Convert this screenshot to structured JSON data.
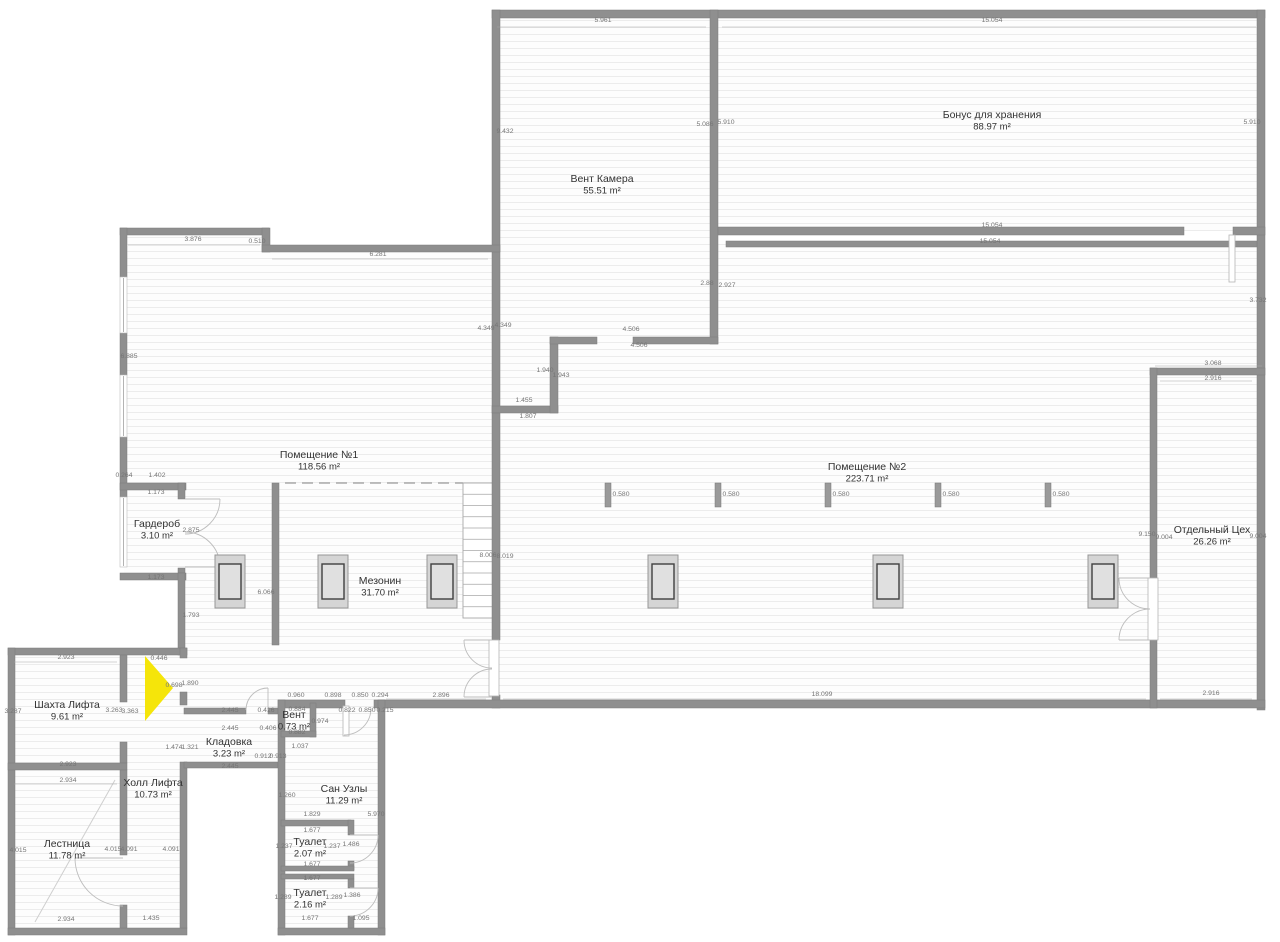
{
  "plan": {
    "colors": {
      "wall": "#8f8f8f",
      "floor_base": "#fdfdfd",
      "hatch_line": "#ececec",
      "highlight_arrow": "#f5e50a",
      "footing_fill": "#d5d5d5",
      "footing_stroke": "#969696",
      "footing_inner_fill": "#e0e0e0",
      "footing_inner_stroke": "#3f3f3f",
      "pillar_fill": "#9a9a9a",
      "dim_text": "#757575",
      "room_text": "#333333"
    },
    "rooms": [
      {
        "id": "vent-kamera",
        "label": "Вент Камера",
        "area": "55.51 m²",
        "x": 602,
        "y": 182
      },
      {
        "id": "bonus-dlya-hraneniya",
        "label": "Бонус для хранения",
        "area": "88.97 m²",
        "x": 992,
        "y": 118
      },
      {
        "id": "pomeshchenie-1",
        "label": "Помещение №1",
        "area": "118.56 m²",
        "x": 319,
        "y": 458
      },
      {
        "id": "pomeshchenie-2",
        "label": "Помещение №2",
        "area": "223.71 m²",
        "x": 867,
        "y": 470
      },
      {
        "id": "otdelny-ceh",
        "label": "Отдельный Цех",
        "area": "26.26 m²",
        "x": 1212,
        "y": 533
      },
      {
        "id": "mezonin",
        "label": "Мезонин",
        "area": "31.70 m²",
        "x": 380,
        "y": 584
      },
      {
        "id": "garderob",
        "label": "Гардероб",
        "area": "3.10 m²",
        "x": 157,
        "y": 527
      },
      {
        "id": "shahta-lifta",
        "label": "Шахта Лифта",
        "area": "9.61 m²",
        "x": 67,
        "y": 708
      },
      {
        "id": "holl-lifta",
        "label": "Холл Лифта",
        "area": "10.73 m²",
        "x": 153,
        "y": 786
      },
      {
        "id": "lestnica",
        "label": "Лестница",
        "area": "11.78 m²",
        "x": 67,
        "y": 847
      },
      {
        "id": "kladovka",
        "label": "Кладовка",
        "area": "3.23 m²",
        "x": 229,
        "y": 745
      },
      {
        "id": "vent",
        "label": "Вент",
        "area": "0.73 m²",
        "x": 294,
        "y": 718
      },
      {
        "id": "san-uzly",
        "label": "Сан Узлы",
        "area": "11.29 m²",
        "x": 344,
        "y": 792
      },
      {
        "id": "tualet-1",
        "label": "Туалет",
        "area": "2.07 m²",
        "x": 310,
        "y": 845
      },
      {
        "id": "tualet-2",
        "label": "Туалет",
        "area": "2.16 m²",
        "x": 310,
        "y": 896
      }
    ],
    "dims": [
      [
        "5.961",
        603,
        22
      ],
      [
        "15.054",
        992,
        22
      ],
      [
        "9.432",
        505,
        133
      ],
      [
        "5.086",
        705,
        126
      ],
      [
        "5.910",
        726,
        124
      ],
      [
        "5.910",
        1252,
        124
      ],
      [
        "15.054",
        992,
        227
      ],
      [
        "15.054",
        990,
        243
      ],
      [
        "3.876",
        193,
        241
      ],
      [
        "0.510",
        257,
        243
      ],
      [
        "6.281",
        378,
        256
      ],
      [
        "6.885",
        129,
        358
      ],
      [
        "2.88",
        707,
        285
      ],
      [
        "2.927",
        727,
        287
      ],
      [
        "4.349",
        486,
        330
      ],
      [
        "4.349",
        503,
        327
      ],
      [
        "4.506",
        631,
        331
      ],
      [
        "4.506",
        639,
        347
      ],
      [
        "3.732",
        1258,
        302
      ],
      [
        "1.940",
        545,
        372
      ],
      [
        "1.943",
        561,
        377
      ],
      [
        "1.455",
        524,
        402
      ],
      [
        "1.807",
        528,
        418
      ],
      [
        "3.068",
        1213,
        365
      ],
      [
        "2.916",
        1213,
        380
      ],
      [
        "0.264",
        124,
        477
      ],
      [
        "1.402",
        157,
        477
      ],
      [
        "1.173",
        156,
        494
      ],
      [
        "2.875",
        191,
        532
      ],
      [
        "1.173",
        156,
        579
      ],
      [
        "1.793",
        191,
        617
      ],
      [
        "6.066",
        266,
        594
      ],
      [
        "8.006",
        488,
        557
      ],
      [
        "8.019",
        505,
        558
      ],
      [
        "9.150",
        1147,
        536
      ],
      [
        "9.004",
        1164,
        539
      ],
      [
        "9.004",
        1258,
        538
      ],
      [
        "18.099",
        822,
        696
      ],
      [
        "2.916",
        1211,
        695
      ],
      [
        "2.896",
        441,
        697
      ],
      [
        "0.446",
        159,
        660
      ],
      [
        "2.923",
        66,
        659
      ],
      [
        "3.287",
        13,
        713
      ],
      [
        "3.263",
        114,
        712
      ],
      [
        "3.363",
        130,
        713
      ],
      [
        "0.698",
        174,
        687
      ],
      [
        "1.890",
        190,
        685
      ],
      [
        "1.474",
        174,
        749
      ],
      [
        "1.321",
        190,
        749
      ],
      [
        "2.923",
        68,
        766
      ],
      [
        "2.934",
        68,
        782
      ],
      [
        "2.445",
        230,
        712
      ],
      [
        "0.416",
        266,
        712
      ],
      [
        "2.445",
        230,
        730
      ],
      [
        "0.406",
        268,
        730
      ],
      [
        "0.912",
        263,
        758
      ],
      [
        "0.913",
        278,
        758
      ],
      [
        "2.445",
        230,
        768
      ],
      [
        "0.960",
        296,
        697
      ],
      [
        "0.898",
        333,
        697
      ],
      [
        "0.850",
        360,
        697
      ],
      [
        "0.294",
        380,
        697
      ],
      [
        "0.884",
        297,
        711
      ],
      [
        "0.822",
        347,
        712
      ],
      [
        "0.850",
        367,
        712
      ],
      [
        "0.215",
        385,
        712
      ],
      [
        "0.974",
        320,
        723
      ],
      [
        "0.882",
        297,
        734
      ],
      [
        "1.037",
        300,
        748
      ],
      [
        "1.260",
        287,
        797
      ],
      [
        "1.829",
        312,
        816
      ],
      [
        "5.970",
        376,
        816
      ],
      [
        "1.677",
        312,
        832
      ],
      [
        "1.237",
        284,
        848
      ],
      [
        "1.237",
        332,
        848
      ],
      [
        "1.486",
        351,
        846
      ],
      [
        "1.677",
        312,
        866
      ],
      [
        "1.677",
        312,
        880
      ],
      [
        "1.289",
        283,
        899
      ],
      [
        "1.289",
        334,
        899
      ],
      [
        "1.386",
        352,
        897
      ],
      [
        "1.677",
        310,
        920
      ],
      [
        "1.095",
        361,
        920
      ],
      [
        "4.015",
        18,
        852
      ],
      [
        "4.015",
        113,
        851
      ],
      [
        "4.091",
        129,
        851
      ],
      [
        "4.091",
        171,
        851
      ],
      [
        "2.934",
        66,
        921
      ],
      [
        "1.435",
        151,
        920
      ]
    ],
    "dim_lines": [
      [
        497,
        27,
        706,
        27
      ],
      [
        722,
        27,
        1256,
        27
      ],
      [
        128,
        245,
        260,
        245
      ],
      [
        272,
        259,
        488,
        259
      ],
      [
        503,
        699,
        1146,
        699
      ],
      [
        1160,
        699,
        1252,
        699
      ],
      [
        386,
        699,
        486,
        699
      ],
      [
        14,
        662,
        117,
        662
      ],
      [
        14,
        784,
        117,
        784
      ],
      [
        1155,
        366,
        1262,
        366
      ],
      [
        1160,
        381,
        1252,
        381
      ]
    ],
    "geometry": {
      "floors": [
        [
          124,
          232,
          144,
          346
        ],
        [
          268,
          249,
          228,
          455
        ],
        [
          185,
          578,
          83,
          126
        ],
        [
          497,
          14,
          216,
          397
        ],
        [
          715,
          14,
          546,
          217
        ],
        [
          715,
          244,
          546,
          460
        ],
        [
          553,
          341,
          165,
          363
        ],
        [
          496,
          411,
          60,
          293
        ],
        [
          12,
          652,
          172,
          280
        ],
        [
          282,
          704,
          100,
          228
        ],
        [
          184,
          652,
          98,
          114
        ]
      ],
      "walls": [
        [
          492,
          10,
          773,
          8
        ],
        [
          492,
          10,
          8,
          403
        ],
        [
          710,
          10,
          8,
          334
        ],
        [
          1257,
          10,
          8,
          700
        ],
        [
          718,
          227,
          466,
          8
        ],
        [
          1233,
          227,
          32,
          8
        ],
        [
          726,
          241,
          531,
          6
        ],
        [
          120,
          228,
          149,
          7
        ],
        [
          262,
          228,
          8,
          24
        ],
        [
          262,
          245,
          238,
          7
        ],
        [
          120,
          228,
          7,
          49
        ],
        [
          120,
          333,
          7,
          42
        ],
        [
          120,
          437,
          7,
          60
        ],
        [
          120,
          483,
          66,
          7
        ],
        [
          178,
          483,
          7,
          16
        ],
        [
          178,
          568,
          7,
          12
        ],
        [
          120,
          573,
          66,
          7
        ],
        [
          178,
          573,
          7,
          82
        ],
        [
          272,
          483,
          7,
          162
        ],
        [
          492,
          406,
          66,
          7
        ],
        [
          550,
          337,
          8,
          76
        ],
        [
          550,
          337,
          47,
          7
        ],
        [
          633,
          337,
          85,
          7
        ],
        [
          492,
          413,
          8,
          227
        ],
        [
          492,
          695,
          8,
          13
        ],
        [
          278,
          700,
          67,
          8
        ],
        [
          374,
          700,
          891,
          8
        ],
        [
          1150,
          368,
          115,
          7
        ],
        [
          1150,
          368,
          7,
          210
        ],
        [
          1150,
          640,
          7,
          68
        ],
        [
          8,
          648,
          179,
          7
        ],
        [
          8,
          648,
          7,
          287
        ],
        [
          8,
          928,
          179,
          7
        ],
        [
          180,
          648,
          7,
          10
        ],
        [
          180,
          692,
          7,
          13
        ],
        [
          180,
          762,
          7,
          166
        ],
        [
          120,
          655,
          7,
          47
        ],
        [
          120,
          742,
          7,
          21
        ],
        [
          8,
          763,
          119,
          7
        ],
        [
          120,
          770,
          7,
          85
        ],
        [
          120,
          905,
          7,
          23
        ],
        [
          184,
          708,
          62,
          6
        ],
        [
          268,
          708,
          10,
          6
        ],
        [
          184,
          762,
          94,
          6
        ],
        [
          278,
          700,
          7,
          235
        ],
        [
          378,
          700,
          7,
          235
        ],
        [
          278,
          928,
          107,
          7
        ],
        [
          310,
          703,
          6,
          34
        ],
        [
          281,
          731,
          35,
          6
        ],
        [
          281,
          820,
          70,
          6
        ],
        [
          348,
          820,
          6,
          15
        ],
        [
          348,
          861,
          6,
          9
        ],
        [
          281,
          866,
          73,
          5
        ],
        [
          281,
          874,
          73,
          5
        ],
        [
          348,
          879,
          6,
          9
        ],
        [
          348,
          916,
          6,
          12
        ]
      ],
      "windows": [
        {
          "rect": [
            120,
            277,
            7,
            56
          ],
          "line": [
            123.5,
            278,
            123.5,
            332
          ]
        },
        {
          "rect": [
            120,
            375,
            7,
            62
          ],
          "line": [
            123.5,
            376,
            123.5,
            436
          ]
        },
        {
          "rect": [
            120,
            497,
            7,
            70
          ],
          "line": [
            123.5,
            498,
            123.5,
            566
          ]
        }
      ],
      "door_arcs": [
        "M220,499 A35,35 0 0 1 185,534",
        "M220,567 A35,35 0 0 0 185,532",
        "M464,640 A28,28 0 0 0 492,668",
        "M464,697 A28,28 0 0 1 492,669",
        "M1119,578 A31,31 0 0 0 1150,609",
        "M1119,640 A31,31 0 0 1 1150,609",
        "M371,708 A27,27 0 0 1 344,735",
        "M246,710 A22,22 0 0 1 268,688",
        "M378,835 A28,28 0 0 1 350,863",
        "M378,888 A28,28 0 0 1 350,916",
        "M123,906 A48,48 0 0 1 75,858"
      ],
      "door_leaves": [
        [
          185,
          499,
          220,
          499
        ],
        [
          185,
          567,
          220,
          567
        ],
        [
          492,
          640,
          464,
          640
        ],
        [
          492,
          697,
          464,
          697
        ],
        [
          1150,
          578,
          1119,
          578
        ],
        [
          1150,
          640,
          1119,
          640
        ],
        [
          268,
          710,
          268,
          688
        ],
        [
          350,
          835,
          378,
          835
        ],
        [
          350,
          888,
          378,
          888
        ],
        [
          123,
          858,
          75,
          858
        ]
      ],
      "door_panels": [
        [
          489,
          640,
          10,
          56
        ],
        [
          1148,
          578,
          10,
          62
        ],
        [
          1229,
          235,
          6,
          47
        ],
        [
          343,
          706,
          6,
          30
        ]
      ],
      "stairs": {
        "x": 463,
        "y": 483,
        "w": 30,
        "h": 135,
        "treads": 12
      },
      "dashed_edge": [
        285,
        483,
        463,
        483
      ],
      "stair_diagonal": [
        115,
        780,
        35,
        922
      ],
      "arrow_points": "145,656 173,688 145,721"
    },
    "columns": {
      "footings_y": 555,
      "footings_cx": [
        230,
        333,
        442,
        663,
        888,
        1103
      ],
      "pillars_x": [
        605,
        715,
        825,
        935,
        1045
      ],
      "pillars_y": 483,
      "pillar_dim": "0.580"
    }
  }
}
